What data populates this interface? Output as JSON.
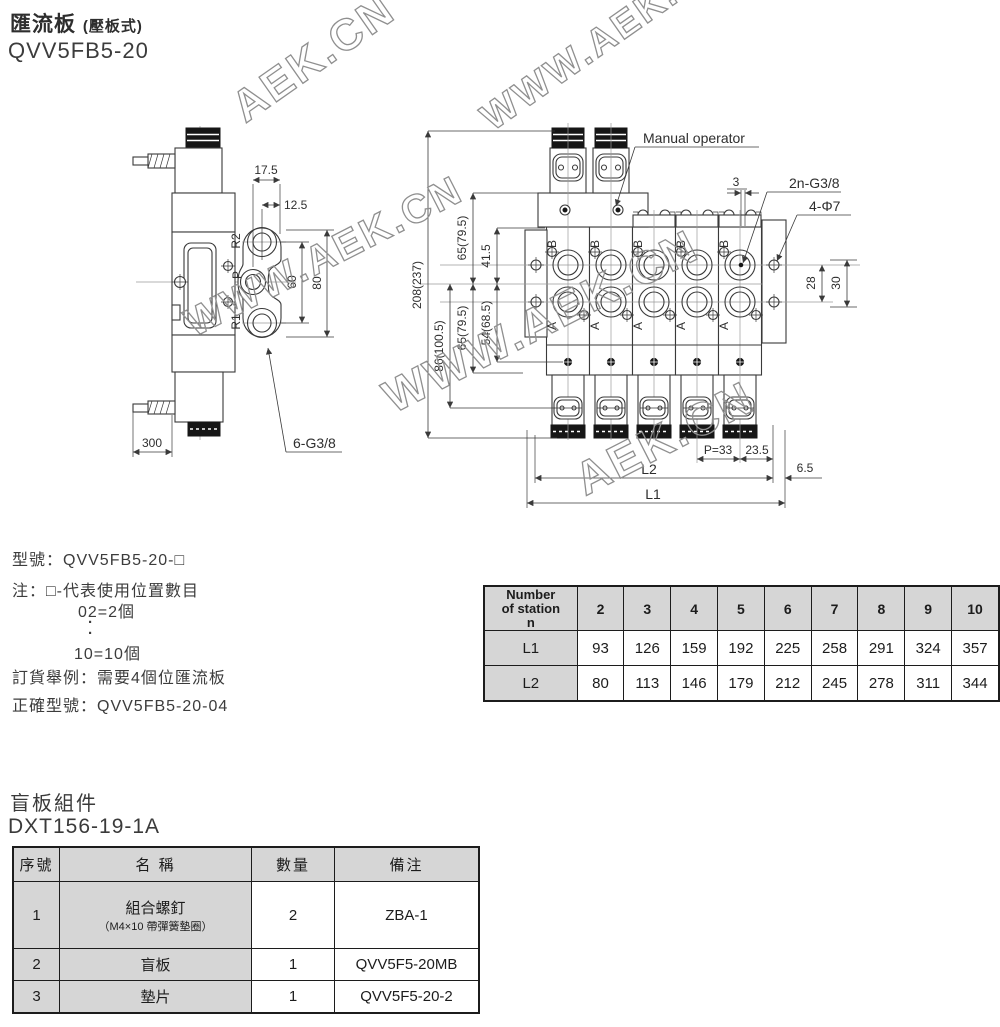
{
  "header": {
    "title": "匯流板",
    "title_paren": "(壓板式)",
    "model": "QVV5FB5-20"
  },
  "watermark": {
    "full": "WWW.AEK.CN",
    "short": "AEK.CN"
  },
  "left_drawing": {
    "dim_17_5": "17.5",
    "dim_12_5": "12.5",
    "dim_60": "60",
    "dim_80": "80",
    "dim_300": "300",
    "label_6g38": "6-G3/8",
    "port_r2": "R2",
    "port_p": "P",
    "port_r1": "R1"
  },
  "right_drawing": {
    "label_manual": "Manual operator",
    "label_2ng38": "2n-G3/8",
    "label_4d7": "4-Φ7",
    "dim_3": "3",
    "dim_208": "208(237)",
    "dim_86": "86(100.5)",
    "dim_65_top": "65(79.5)",
    "dim_65_bot": "65(79.5)",
    "dim_41_5": "41.5",
    "dim_54": "54(68.5)",
    "dim_28": "28",
    "dim_30": "30",
    "dim_p33": "P=33",
    "dim_23_5": "23.5",
    "dim_6_5": "6.5",
    "dim_l2": "L2",
    "dim_l1": "L1",
    "port_b": "B",
    "port_a": "A"
  },
  "order_info": {
    "model_line": "型號：QVV5FB5-20-□",
    "note": "注：□-代表使用位置數目",
    "opt_min": "02=2個",
    "dot": "·",
    "opt_max": "10=10個",
    "example": "訂貨舉例：需要4個位匯流板",
    "correct": "正確型號：QVV5FB5-20-04"
  },
  "station_table": {
    "header_line1": "Number",
    "header_line2": "of station",
    "header_line3": "n",
    "columns": [
      "2",
      "3",
      "4",
      "5",
      "6",
      "7",
      "8",
      "9",
      "10"
    ],
    "rows": [
      {
        "label": "L1",
        "values": [
          "93",
          "126",
          "159",
          "192",
          "225",
          "258",
          "291",
          "324",
          "357"
        ]
      },
      {
        "label": "L2",
        "values": [
          "80",
          "113",
          "146",
          "179",
          "212",
          "245",
          "278",
          "311",
          "344"
        ]
      }
    ]
  },
  "blank_plate": {
    "title": "盲板組件",
    "model": "DXT156-19-1A",
    "headers": [
      "序號",
      "名 稱",
      "數量",
      "備注"
    ],
    "rows": [
      {
        "no": "1",
        "name": "組合螺釘",
        "name_note": "（M4×10 帶彈簧墊圈）",
        "qty": "2",
        "remark": "ZBA-1"
      },
      {
        "no": "2",
        "name": "盲板",
        "qty": "1",
        "remark": "QVV5F5-20MB"
      },
      {
        "no": "3",
        "name": "墊片",
        "qty": "1",
        "remark": "QVV5F5-20-2"
      }
    ]
  },
  "colors": {
    "line": "#3a3a3a",
    "table_header_bg": "#d6d6d6",
    "watermark": "#8f8f8f"
  }
}
